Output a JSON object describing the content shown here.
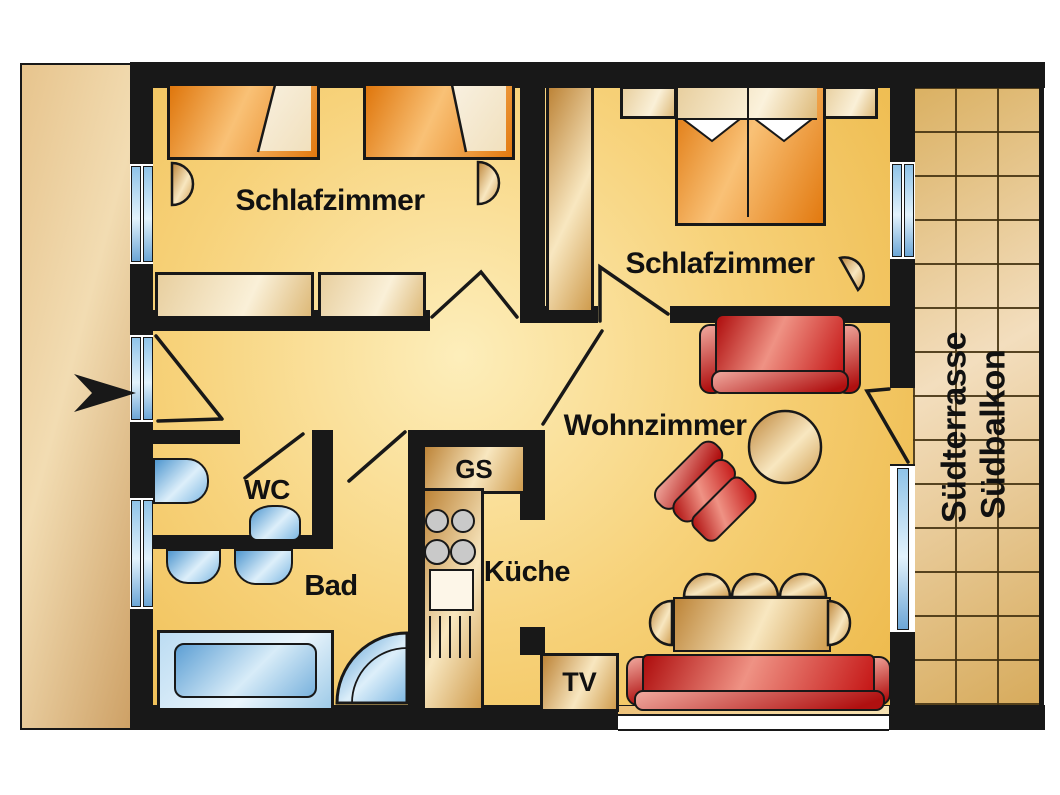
{
  "plan": {
    "rooms": {
      "bedroom_left": "Schlafzimmer",
      "bedroom_right": "Schlafzimmer",
      "living": "Wohnzimmer",
      "wc": "WC",
      "bath": "Bad",
      "kitchen": "Küche"
    },
    "terrace": {
      "line1": "Südterrasse",
      "line2": "Südbalkon"
    },
    "fixtures": {
      "dishwasher": "GS",
      "tv": "TV"
    },
    "colors": {
      "wall": "#181818",
      "floor_gold": "#f7d27a",
      "terrace_tan": "#e3c07f",
      "furniture_orange": "#ef9f3d",
      "sofa_red": "#c41414",
      "sanitary_blue": "#a8d3ee",
      "wood_tan": "#e3bd7e",
      "exterior_band": "#e7c48d"
    }
  }
}
